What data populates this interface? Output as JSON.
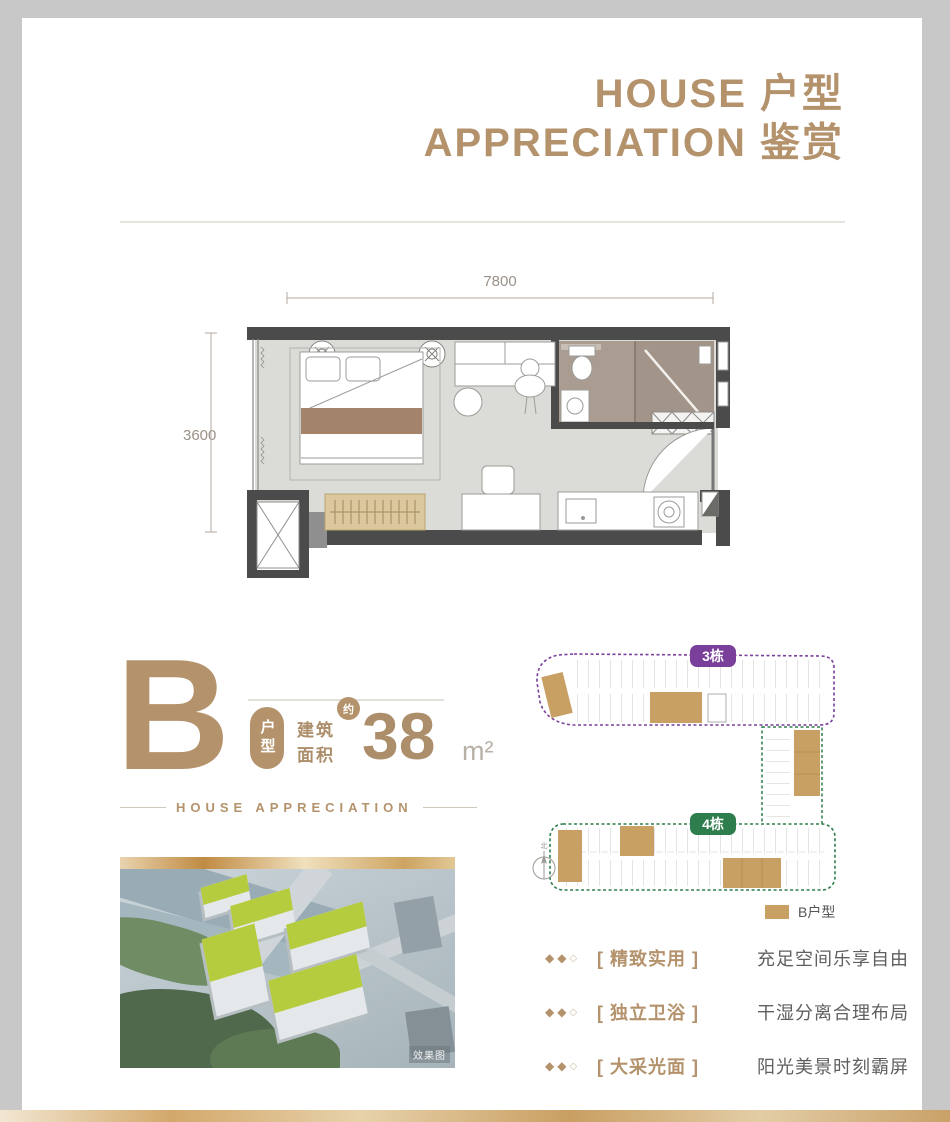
{
  "header": {
    "line1": "HOUSE 户型",
    "line2": "APPRECIATION 鉴赏"
  },
  "floor_plan": {
    "dim_width": "7800",
    "dim_height": "3600"
  },
  "unit_info": {
    "letter": "B",
    "type_badge": "户型",
    "approx_badge": "约",
    "area_label_line1": "建筑",
    "area_label_line2": "面积",
    "area_value": "38",
    "area_unit": "m²",
    "subtitle": "HOUSE APPRECIATION"
  },
  "render_image": {
    "watermark": "效果图"
  },
  "site_plan": {
    "building3_label": "3栋",
    "building4_label": "4栋",
    "compass_label": "北",
    "legend_label": "B户型",
    "unit_highlight_color": "#c9a063",
    "building3_outline_color": "#7a3f9b",
    "building4_outline_color": "#2e7d4c"
  },
  "features": [
    {
      "bullets": [
        "◆",
        "◆",
        "◇"
      ],
      "title": "[ 精致实用 ]",
      "desc": "充足空间乐享自由"
    },
    {
      "bullets": [
        "◆",
        "◆",
        "◇"
      ],
      "title": "[ 独立卫浴 ]",
      "desc": "干湿分离合理布局"
    },
    {
      "bullets": [
        "◆",
        "◆",
        "◇"
      ],
      "title": "[ 大采光面 ]",
      "desc": "阳光美景时刻霸屏"
    }
  ],
  "colors": {
    "accent_gold": "#b4936c",
    "text_gray": "#5f5f5f",
    "wall_dark": "#4b4b4b"
  }
}
